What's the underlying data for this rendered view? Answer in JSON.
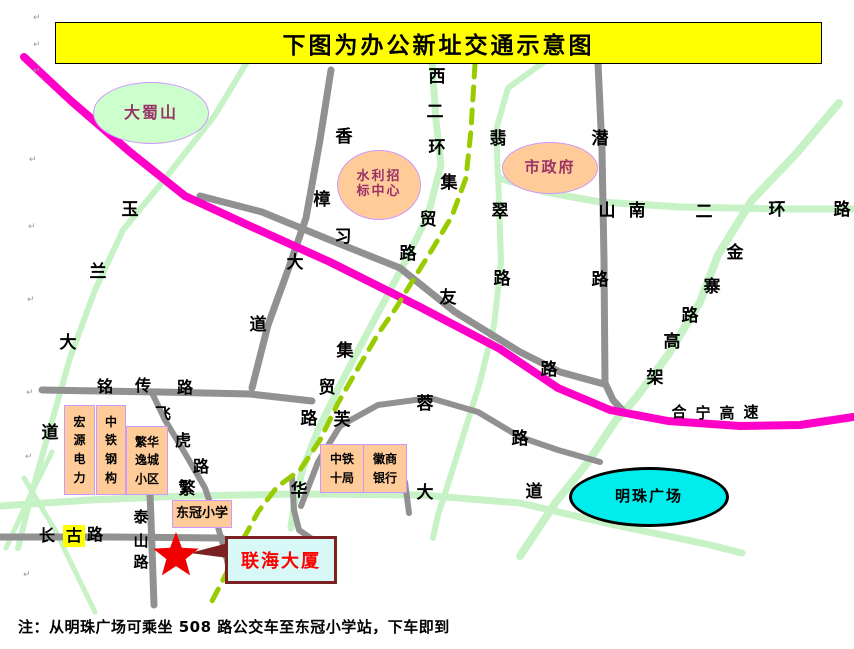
{
  "title": {
    "text": "下图为办公新址交通示意图",
    "x": 55,
    "y": 22,
    "w": 765,
    "h": 40
  },
  "note": {
    "text": "注：从明珠广场可乘坐 508 路公交车至东冠小学站，下车即到",
    "x": 18,
    "y": 616
  },
  "colors": {
    "green": "#C6F2C6",
    "gray": "#919191",
    "highway": "#FF00C8",
    "dashed": "#99CC00",
    "star": "#F00000",
    "callout_border": "#7B2121"
  },
  "roads": [
    {
      "id": "yulan-dadao",
      "layer": "green",
      "width": 6,
      "points": [
        [
          247,
          62
        ],
        [
          215,
          115
        ],
        [
          160,
          185
        ],
        [
          123,
          230
        ],
        [
          95,
          290
        ],
        [
          70,
          358
        ],
        [
          50,
          428
        ],
        [
          32,
          492
        ],
        [
          18,
          548
        ]
      ]
    },
    {
      "id": "xierhuan-jimao",
      "layer": "green",
      "width": 7,
      "points": [
        [
          432,
          62
        ],
        [
          436,
          120
        ],
        [
          441,
          165
        ],
        [
          428,
          215
        ],
        [
          406,
          260
        ],
        [
          385,
          300
        ],
        [
          362,
          343
        ],
        [
          340,
          385
        ],
        [
          318,
          430
        ],
        [
          303,
          468
        ],
        [
          294,
          505
        ],
        [
          291,
          528
        ]
      ]
    },
    {
      "id": "feicui-lu",
      "layer": "green",
      "width": 6,
      "points": [
        [
          544,
          62
        ],
        [
          508,
          88
        ],
        [
          496,
          130
        ],
        [
          499,
          200
        ],
        [
          501,
          262
        ],
        [
          494,
          325
        ],
        [
          480,
          382
        ],
        [
          465,
          430
        ],
        [
          450,
          478
        ],
        [
          438,
          515
        ],
        [
          433,
          538
        ]
      ]
    },
    {
      "id": "nanerhuan-lu",
      "layer": "green",
      "width": 7,
      "points": [
        [
          499,
          178
        ],
        [
          545,
          192
        ],
        [
          600,
          202
        ],
        [
          680,
          207
        ],
        [
          780,
          209
        ],
        [
          854,
          209
        ]
      ]
    },
    {
      "id": "jinzhai-gaojia",
      "layer": "green",
      "width": 8,
      "points": [
        [
          839,
          103
        ],
        [
          795,
          155
        ],
        [
          752,
          200
        ],
        [
          718,
          255
        ],
        [
          700,
          302
        ],
        [
          668,
          355
        ],
        [
          636,
          398
        ],
        [
          616,
          420
        ],
        [
          588,
          462
        ],
        [
          556,
          502
        ],
        [
          520,
          556
        ]
      ]
    },
    {
      "id": "fanhua-dadao",
      "layer": "green",
      "width": 7,
      "points": [
        [
          0,
          506
        ],
        [
          90,
          500
        ],
        [
          185,
          496
        ],
        [
          300,
          494
        ],
        [
          420,
          495
        ],
        [
          520,
          503
        ],
        [
          610,
          524
        ],
        [
          706,
          544
        ],
        [
          742,
          553
        ]
      ]
    },
    {
      "id": "diag-sw-a",
      "layer": "green",
      "width": 5,
      "points": [
        [
          52,
          452
        ],
        [
          28,
          500
        ],
        [
          6,
          548
        ]
      ]
    },
    {
      "id": "diag-sw-b",
      "layer": "green",
      "width": 5,
      "points": [
        [
          24,
          478
        ],
        [
          55,
          530
        ],
        [
          95,
          612
        ]
      ]
    },
    {
      "id": "qianshan-lu",
      "layer": "gray",
      "width": 7,
      "points": [
        [
          598,
          63
        ],
        [
          602,
          150
        ],
        [
          604,
          260
        ],
        [
          605,
          383
        ],
        [
          613,
          400
        ],
        [
          624,
          412
        ]
      ]
    },
    {
      "id": "xiyou-lu",
      "layer": "gray",
      "width": 7,
      "points": [
        [
          200,
          196
        ],
        [
          262,
          212
        ],
        [
          330,
          240
        ],
        [
          400,
          268
        ],
        [
          455,
          312
        ],
        [
          520,
          352
        ],
        [
          560,
          372
        ],
        [
          604,
          384
        ]
      ]
    },
    {
      "id": "xiangzhang-dadao",
      "layer": "gray",
      "width": 7,
      "points": [
        [
          331,
          70
        ],
        [
          320,
          140
        ],
        [
          306,
          218
        ],
        [
          288,
          270
        ],
        [
          268,
          325
        ],
        [
          252,
          388
        ]
      ]
    },
    {
      "id": "mingchuan-lu",
      "layer": "gray",
      "width": 7,
      "points": [
        [
          42,
          390
        ],
        [
          160,
          392
        ],
        [
          250,
          394
        ],
        [
          312,
          401
        ]
      ]
    },
    {
      "id": "feihu-lu",
      "layer": "gray",
      "width": 6,
      "points": [
        [
          152,
          393
        ],
        [
          165,
          420
        ],
        [
          186,
          455
        ],
        [
          205,
          488
        ],
        [
          216,
          520
        ],
        [
          225,
          552
        ],
        [
          228,
          565
        ]
      ]
    },
    {
      "id": "furong-lu",
      "layer": "gray",
      "width": 6,
      "points": [
        [
          301,
          506
        ],
        [
          318,
          462
        ],
        [
          340,
          426
        ],
        [
          378,
          405
        ],
        [
          430,
          398
        ],
        [
          478,
          412
        ],
        [
          520,
          437
        ],
        [
          558,
          450
        ],
        [
          600,
          462
        ]
      ]
    },
    {
      "id": "changgu-lu",
      "layer": "gray",
      "width": 7,
      "points": [
        [
          0,
          537
        ],
        [
          110,
          537
        ],
        [
          222,
          538
        ]
      ]
    },
    {
      "id": "taishan-lu",
      "layer": "gray",
      "width": 7,
      "points": [
        [
          149,
          467
        ],
        [
          151,
          520
        ],
        [
          154,
          605
        ]
      ]
    },
    {
      "id": "stub-hua",
      "layer": "gray",
      "width": 6,
      "points": [
        [
          292,
          477
        ],
        [
          294,
          510
        ],
        [
          299,
          530
        ],
        [
          312,
          539
        ]
      ]
    },
    {
      "id": "stub-da",
      "layer": "gray",
      "width": 6,
      "points": [
        [
          405,
          482
        ],
        [
          409,
          513
        ]
      ]
    },
    {
      "id": "heining-gaosu",
      "layer": "highway",
      "width": 8,
      "points": [
        [
          24,
          57
        ],
        [
          70,
          100
        ],
        [
          130,
          152
        ],
        [
          185,
          196
        ],
        [
          250,
          226
        ],
        [
          330,
          262
        ],
        [
          420,
          307
        ],
        [
          500,
          349
        ],
        [
          558,
          388
        ],
        [
          610,
          410
        ],
        [
          668,
          421
        ],
        [
          740,
          426
        ],
        [
          800,
          425
        ],
        [
          853,
          417
        ]
      ]
    },
    {
      "id": "dashed-line",
      "layer": "dashed",
      "width": 5,
      "dash": "13 10",
      "points": [
        [
          475,
          64
        ],
        [
          471,
          130
        ],
        [
          466,
          178
        ],
        [
          452,
          216
        ],
        [
          433,
          248
        ],
        [
          413,
          280
        ],
        [
          396,
          308
        ],
        [
          378,
          334
        ],
        [
          357,
          370
        ],
        [
          338,
          403
        ],
        [
          320,
          440
        ],
        [
          300,
          470
        ],
        [
          277,
          487
        ],
        [
          258,
          512
        ],
        [
          240,
          545
        ],
        [
          224,
          578
        ],
        [
          210,
          605
        ]
      ]
    }
  ],
  "road_labels": [
    {
      "road": "xiangzhang-dadao",
      "fs": 17,
      "chars": [
        {
          "c": "香",
          "x": 344,
          "y": 137
        },
        {
          "c": "樟",
          "x": 322,
          "y": 200
        },
        {
          "c": "大",
          "x": 295,
          "y": 263
        },
        {
          "c": "道",
          "x": 258,
          "y": 325
        }
      ]
    },
    {
      "road": "xierhuan",
      "fs": 17,
      "chars": [
        {
          "c": "西",
          "x": 437,
          "y": 77
        },
        {
          "c": "二",
          "x": 435,
          "y": 112
        },
        {
          "c": "环",
          "x": 437,
          "y": 148
        }
      ]
    },
    {
      "road": "jimao-lu-upper",
      "fs": 17,
      "chars": [
        {
          "c": "集",
          "x": 449,
          "y": 183
        },
        {
          "c": "贸",
          "x": 428,
          "y": 220
        },
        {
          "c": "路",
          "x": 408,
          "y": 254
        }
      ]
    },
    {
      "road": "feicui-lu",
      "fs": 17,
      "chars": [
        {
          "c": "翡",
          "x": 498,
          "y": 139
        },
        {
          "c": "翠",
          "x": 500,
          "y": 212
        },
        {
          "c": "路",
          "x": 502,
          "y": 279
        }
      ]
    },
    {
      "road": "xiyou-lu",
      "fs": 17,
      "chars": [
        {
          "c": "习",
          "x": 343,
          "y": 237
        },
        {
          "c": "友",
          "x": 448,
          "y": 298
        },
        {
          "c": "路",
          "x": 549,
          "y": 370
        }
      ]
    },
    {
      "road": "qianshan-lu",
      "fs": 17,
      "chars": [
        {
          "c": "潜",
          "x": 600,
          "y": 139
        },
        {
          "c": "山",
          "x": 607,
          "y": 211
        },
        {
          "c": "路",
          "x": 600,
          "y": 280
        }
      ]
    },
    {
      "road": "nanerhuan-lu",
      "fs": 17,
      "chars": [
        {
          "c": "南",
          "x": 637,
          "y": 211
        },
        {
          "c": "二",
          "x": 704,
          "y": 212
        },
        {
          "c": "环",
          "x": 777,
          "y": 210
        },
        {
          "c": "路",
          "x": 842,
          "y": 210
        }
      ]
    },
    {
      "road": "jinzhai-gaojia",
      "fs": 17,
      "chars": [
        {
          "c": "金",
          "x": 735,
          "y": 253
        },
        {
          "c": "寨",
          "x": 712,
          "y": 287
        },
        {
          "c": "路",
          "x": 690,
          "y": 316
        },
        {
          "c": "高",
          "x": 672,
          "y": 342
        },
        {
          "c": "架",
          "x": 655,
          "y": 378
        }
      ]
    },
    {
      "road": "yulan-dadao",
      "fs": 17,
      "chars": [
        {
          "c": "玉",
          "x": 130,
          "y": 210
        },
        {
          "c": "兰",
          "x": 98,
          "y": 272
        },
        {
          "c": "大",
          "x": 68,
          "y": 343
        },
        {
          "c": "道",
          "x": 50,
          "y": 433
        }
      ]
    },
    {
      "road": "mingchuan-lu",
      "fs": 16,
      "chars": [
        {
          "c": "铭",
          "x": 105,
          "y": 387
        },
        {
          "c": "传",
          "x": 143,
          "y": 386
        },
        {
          "c": "路",
          "x": 185,
          "y": 388
        }
      ]
    },
    {
      "road": "feihu-lu",
      "fs": 16,
      "chars": [
        {
          "c": "飞",
          "x": 163,
          "y": 414
        },
        {
          "c": "虎",
          "x": 183,
          "y": 441
        },
        {
          "c": "路",
          "x": 201,
          "y": 467
        }
      ]
    },
    {
      "road": "jimao-lu-lower",
      "fs": 17,
      "chars": [
        {
          "c": "集",
          "x": 345,
          "y": 351
        },
        {
          "c": "贸",
          "x": 327,
          "y": 388
        },
        {
          "c": "路",
          "x": 309,
          "y": 419
        }
      ]
    },
    {
      "road": "furong-lu",
      "fs": 17,
      "chars": [
        {
          "c": "芙",
          "x": 342,
          "y": 420
        },
        {
          "c": "蓉",
          "x": 425,
          "y": 404
        },
        {
          "c": "路",
          "x": 520,
          "y": 439
        }
      ]
    },
    {
      "road": "fanhua-dadao",
      "fs": 17,
      "chars": [
        {
          "c": "繁",
          "x": 187,
          "y": 489
        },
        {
          "c": "华",
          "x": 299,
          "y": 491
        },
        {
          "c": "大",
          "x": 425,
          "y": 493
        },
        {
          "c": "道",
          "x": 534,
          "y": 492
        }
      ]
    },
    {
      "road": "heining-gaosu",
      "fs": 15,
      "chars": [
        {
          "c": "合",
          "x": 679,
          "y": 412
        },
        {
          "c": "宁",
          "x": 703,
          "y": 413
        },
        {
          "c": "高",
          "x": 727,
          "y": 413
        },
        {
          "c": "速",
          "x": 751,
          "y": 412
        }
      ]
    },
    {
      "road": "changgu-lu",
      "fs": 16,
      "chars": [
        {
          "c": "长",
          "x": 47,
          "y": 536
        },
        {
          "c": "古",
          "x": 74,
          "y": 536,
          "hl": true
        },
        {
          "c": "路",
          "x": 95,
          "y": 535
        }
      ]
    },
    {
      "road": "taishan-lu",
      "fs": 15,
      "chars": [
        {
          "c": "泰",
          "x": 141,
          "y": 517
        },
        {
          "c": "山",
          "x": 141,
          "y": 541
        },
        {
          "c": "路",
          "x": 141,
          "y": 562
        }
      ]
    }
  ],
  "landmarks": [
    {
      "id": "dashushan",
      "lines": [
        "大蜀山"
      ],
      "cx": 150,
      "cy": 112,
      "rx": 57,
      "ry": 30,
      "fill": "#CCFFCC",
      "stroke": "#CC99FF",
      "sw": 1.5,
      "color": "#993366",
      "fs": 16
    },
    {
      "id": "shuili-zhaobiao",
      "lines": [
        "水利招",
        "标中心"
      ],
      "cx": 378,
      "cy": 184,
      "rx": 41,
      "ry": 34,
      "fill": "#FFCC99",
      "stroke": "#CC99FF",
      "sw": 1.5,
      "color": "#993366",
      "fs": 13
    },
    {
      "id": "shizhengfu",
      "lines": [
        "市政府"
      ],
      "cx": 549,
      "cy": 167,
      "rx": 47,
      "ry": 25,
      "fill": "#FFCC99",
      "stroke": "#CC99FF",
      "sw": 1.5,
      "color": "#993366",
      "fs": 15
    },
    {
      "id": "mingzhu-guangchang",
      "lines": [
        "明珠广场"
      ],
      "cx": 646,
      "cy": 494,
      "rx": 77,
      "ry": 27,
      "fill": "#00EDED",
      "stroke": "#000000",
      "sw": 3,
      "color": "#000000",
      "fs": 15
    }
  ],
  "buildings": [
    {
      "id": "hongyuan-dianli",
      "lines": [
        "宏",
        "源",
        "电",
        "力"
      ],
      "x": 64,
      "y": 405,
      "w": 29,
      "h": 88,
      "fs": 12
    },
    {
      "id": "zhongtie-ganggou",
      "lines": [
        "中",
        "铁",
        "钢",
        "构"
      ],
      "x": 96,
      "y": 405,
      "w": 28,
      "h": 88,
      "fs": 12
    },
    {
      "id": "fanhua-yicheng",
      "lines": [
        "繁华",
        "逸城",
        "小区"
      ],
      "x": 126,
      "y": 426,
      "w": 40,
      "h": 67,
      "fs": 12
    },
    {
      "id": "zhongtie-shiju",
      "lines": [
        "中铁",
        "十局"
      ],
      "x": 320,
      "y": 444,
      "w": 42,
      "h": 47,
      "fs": 12
    },
    {
      "id": "huishang-yinhang",
      "lines": [
        "徽商",
        "银行"
      ],
      "x": 363,
      "y": 444,
      "w": 42,
      "h": 47,
      "fs": 12
    },
    {
      "id": "dongguan-xiaoxue",
      "lines": [
        "东冠小学"
      ],
      "x": 172,
      "y": 500,
      "w": 58,
      "h": 26,
      "fs": 13
    }
  ],
  "destination": {
    "label": "联海大厦",
    "box": {
      "x": 225,
      "y": 536,
      "w": 106,
      "h": 42
    },
    "star": {
      "cx": 176,
      "cy": 556,
      "r": 24
    },
    "tail": [
      [
        228,
        543
      ],
      [
        228,
        558
      ],
      [
        190,
        553
      ]
    ]
  },
  "margin_marks": [
    {
      "x": 33,
      "y": 13
    },
    {
      "x": 33,
      "y": 40
    },
    {
      "x": 33,
      "y": 66
    },
    {
      "x": 29,
      "y": 155
    },
    {
      "x": 28,
      "y": 222
    },
    {
      "x": 27,
      "y": 295
    },
    {
      "x": 26,
      "y": 388
    },
    {
      "x": 25,
      "y": 452
    },
    {
      "x": 23,
      "y": 570
    }
  ]
}
